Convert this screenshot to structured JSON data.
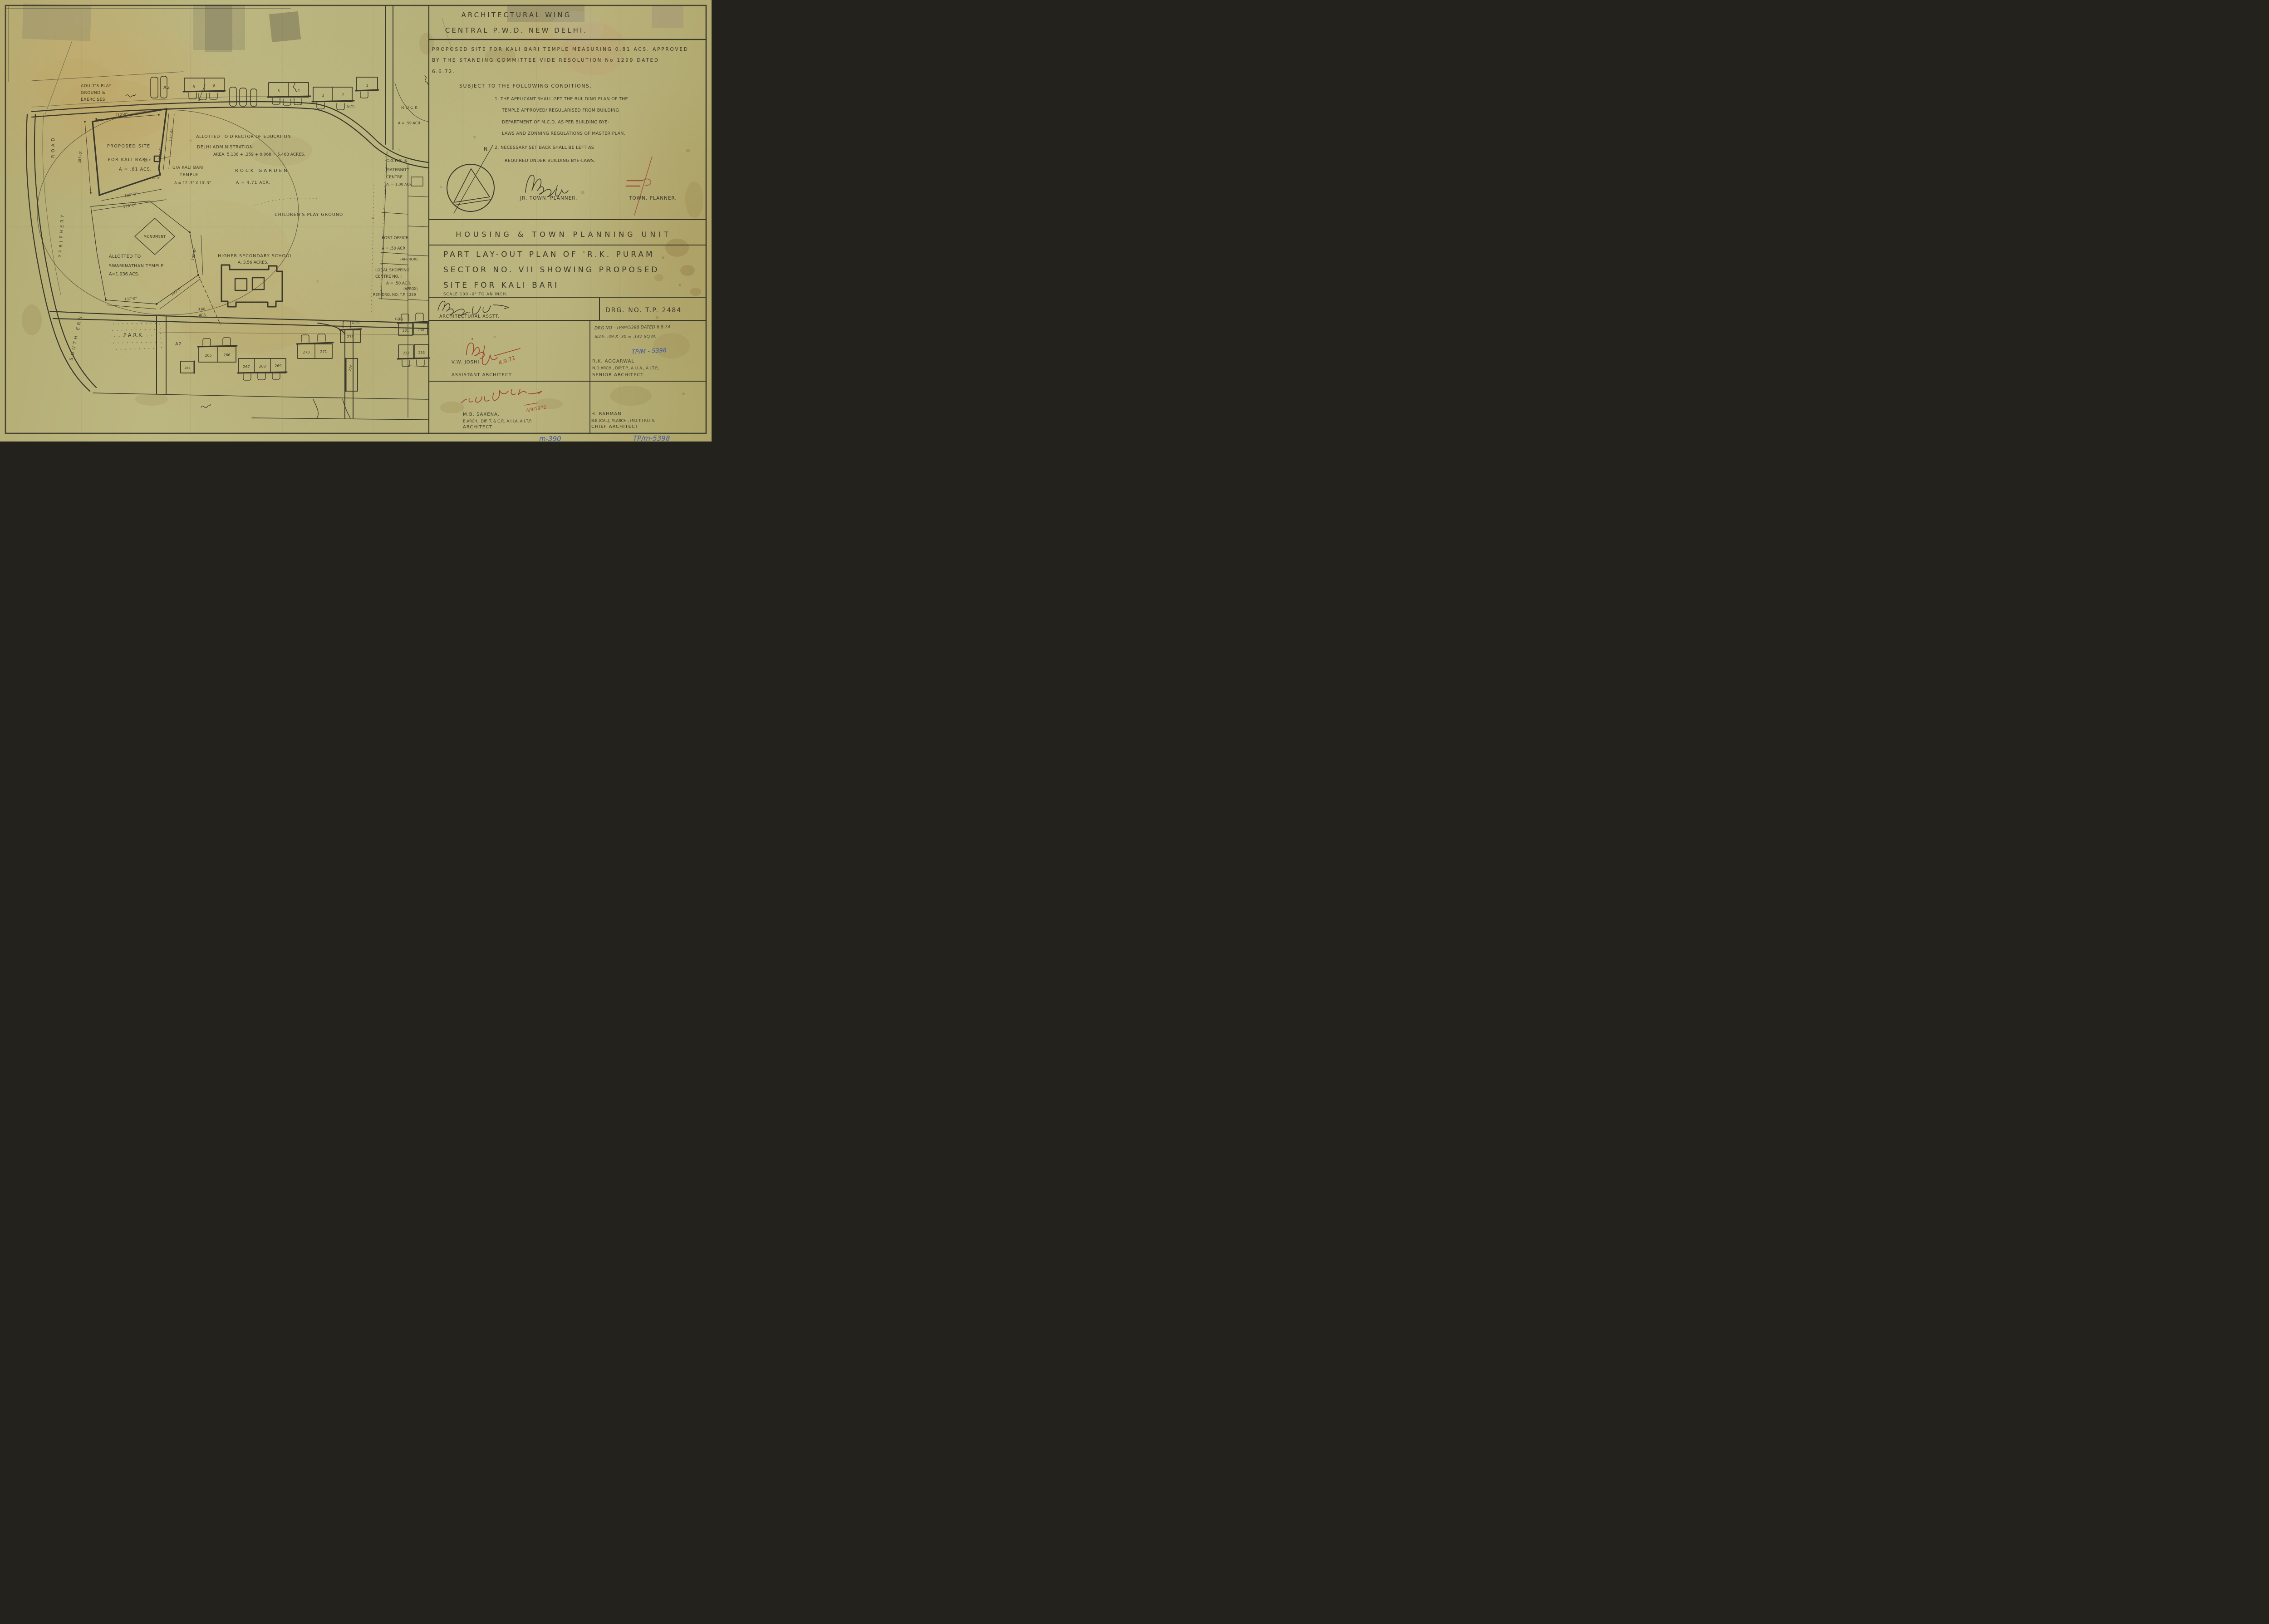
{
  "panel": {
    "header_line1": "ARCHITECTURAL WING",
    "header_line2": "CENTRAL P.W.D. NEW DELHI.",
    "approval_line1": "PROPOSED SITE FOR KALI BARI TEMPLE MEASURING 0.81 ACS. APPROVED",
    "approval_line2": "BY THE STANDING COMMITTEE VIDE RESOLUTION No 1299 DATED",
    "approval_line3": "6.6.72.",
    "subject": "SUBJECT TO THE FOLLOWING CONDITIONS.",
    "cond1_line1": "1. THE APPLICANT SHALL GET THE BUILDING PLAN OF THE",
    "cond1_line2": "TEMPLE APPROVED/ REGULARISED FROM BUILDING",
    "cond1_line3": "DEPARTMENT OF M.C.D. AS PER BUILDING BYE-",
    "cond1_line4": "LAWS AND ZONNING REGULATIONS OF MASTER PLAN.",
    "cond2_line1": "2. NECESSARY SET BACK SHALL BE LEFT AS",
    "cond2_line2": "REQUIRED UNDER BUILDING BYE-LAWS.",
    "north_label": "N",
    "jr_town_planner": "JR. TOWN. PLANNER.",
    "town_planner": "TOWN. PLANNER.",
    "unit_title": "HOUSING & TOWN PLANNING UNIT",
    "title_line1": "PART LAY-OUT PLAN OF 'R.K. PURAM",
    "title_line2": "SECTOR NO. VII  SHOWING PROPOSED",
    "title_line3": "SITE FOR KALI BARI",
    "scale_note": "SCALE 100'-0\" TO AN INCH.",
    "arch_asstt": "ARCHITECTURAL ASSTT.",
    "drg_no": "DRG. NO. T.P. 2484",
    "drg_note1": "DRG NO - TP/M/5398 DATED 6.8.74",
    "drg_note2": "SIZE: .49 X .30 = .147 SQ M.",
    "blue_ref": "TP/M - 5398",
    "joshi_date": "4.9.72",
    "joshi_name": "V.W. JOSHI",
    "joshi_role": "ASSISTANT ARCHITECT",
    "aggarwal_name": "R.K. AGGARWAL",
    "aggarwal_quals": "N.D.ARCH., DIP.T.P., A.I.I.A., A.I.T.P.,",
    "aggarwal_role": "SENIOR ARCHITECT.",
    "saxena_date": "4/9/1972",
    "saxena_name": "M.B. SAXENA.",
    "saxena_quals": "B.ARCH., DIP. T. & C.P., A.I.I.A. A.I.T.P.",
    "saxena_role": "ARCHITECT",
    "rahman_name": "H. RAHMAN",
    "rahman_quals": "B.E.(CAL), M.ARCH., (M.I.T.) F.I.I.A.",
    "rahman_role": "CHIEF ARCHITECT",
    "margin_blue_left": "m-390",
    "margin_blue_right": "TP/m-5398"
  },
  "map": {
    "periphery_road_word1": "SOUTH ERN",
    "periphery_road_word2": "PERIPHERY",
    "periphery_road_word3": "ROAD",
    "adults_line1": "ADULT'S PLAY",
    "adults_line2": "GROUND &",
    "adults_line3": "EXERCISES",
    "a2": "A2",
    "gy": "G(Y)",
    "gr": "G(R)",
    "rock_line1": "ROCK",
    "rock_line2": "A = .59 ACR.",
    "proposed_line1": "PROPOSED SITE",
    "proposed_line2": "FOR KALI BARI",
    "proposed_line3": "A = .81 ACS.",
    "temple_line1": "U/A KALI BARI",
    "temple_line2": "TEMPLE",
    "temple_line3": "A = 12'-3\" X 10'-3\"",
    "education_line1": "ALLOTTED TO DIRECTOR OF EDUCATION",
    "education_line2": "DELHI ADMINISTRATION",
    "education_line3": "AREA. 5.136 + .259 + 0.068 = 5.463 ACRES.",
    "rock_garden_line1": "ROCK GARDEN",
    "rock_garden_line2": "A = 4.71 ACR.",
    "cghs_line1": "C.G.H.S. &",
    "cghs_line2": "MATERNITY",
    "cghs_line3": "CENTRE",
    "cghs_line4": "A. = 1.00 ACR",
    "children_label": "CHILDREN'S PLAY GROUND",
    "monument_label": "MONUMENT",
    "swami_line1": "ALLOTTED TO",
    "swami_line2": "SWAMINATHAN TEMPLE",
    "swami_line3": "A=1.036 ACS.",
    "school_line1": "HIGHER SECONDARY SCHOOL",
    "school_line2": "A. 3.56 ACRES.",
    "post_line1": "POST OFFICE",
    "post_line2": "A = .50 ACR",
    "post_line3": "(APPROX)",
    "shop_line1": "LOCAL SHOPPING",
    "shop_line2": "CENTRE NO. I",
    "shop_line3": "A = .50 ACR.",
    "shop_line4": "(APROX)",
    "shop_line5": "REF. DRG. NO. T.P. 1339",
    "park_label": "PARK",
    "dim_210": "210'-0\"",
    "dim_185_left": "185'-0\"",
    "dim_185_right": "185'-0\"",
    "dim_131": "131'-6\"",
    "dim_180": "180'-0\"",
    "dim_170": "170'-0\"",
    "dim_137": "137'-0\"",
    "dim_109_diag": "109'-0\"",
    "dim_109_vert": "109'-0\"",
    "dim_12_3": "12'-3\"",
    "dim_10_3": "10'-3\"",
    "dim_068_line1": "0.68",
    "dim_068_line2": "ACS.",
    "houses_top": [
      "9",
      "8",
      "5",
      "4",
      "3",
      "2",
      "1"
    ],
    "houses_bottom": [
      "265",
      "266",
      "264",
      "267",
      "268",
      "269",
      "270",
      "271",
      "273",
      "274",
      "231",
      "230",
      "232",
      "233"
    ]
  }
}
